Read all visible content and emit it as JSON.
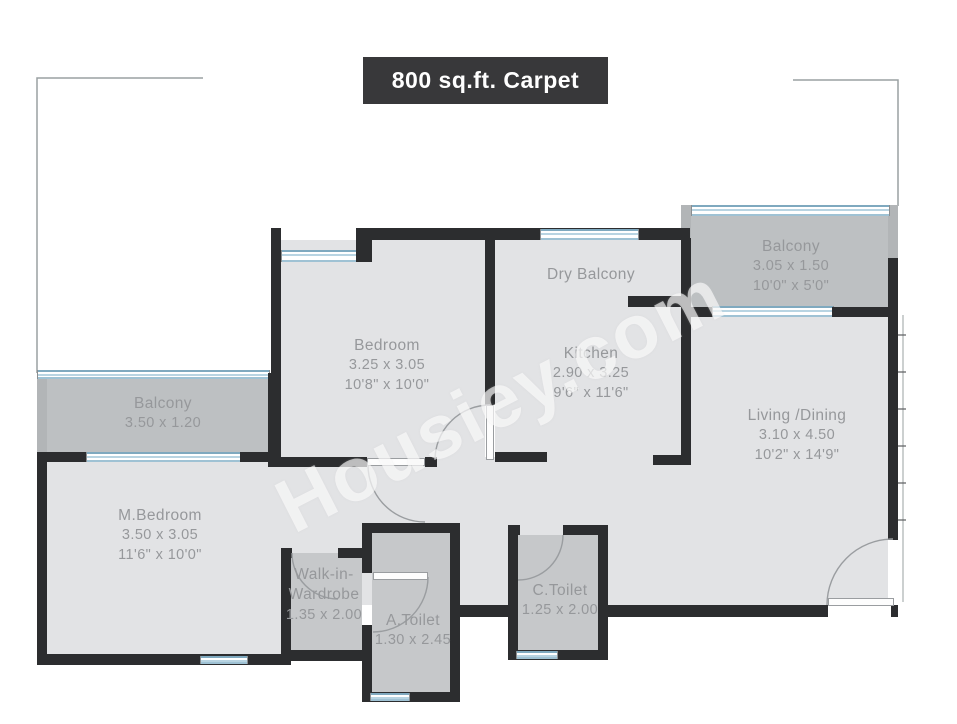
{
  "title": "800 sq.ft. Carpet",
  "watermark": "Housiey.com",
  "colors": {
    "wall": "#2c2d2f",
    "floor": "#e2e3e5",
    "balcony_floor": "#bdc0c2",
    "wet_area_floor": "#c6c8ca",
    "window_glass": "#b8d4e2",
    "title_background": "#38383a",
    "title_text": "#ffffff",
    "label_text": "#96989b",
    "watermark_text": "rgba(255,255,255,0.62)"
  },
  "rooms": [
    {
      "name": "Bedroom",
      "dim_m": "3.25 x 3.05",
      "dim_ft": "10'8\" x 10'0\""
    },
    {
      "name": "Dry Balcony",
      "dim_m": "",
      "dim_ft": ""
    },
    {
      "name": "Kitchen",
      "dim_m": "2.90 x 3.25",
      "dim_ft": "9'6\" x 11'6\""
    },
    {
      "name": "Balcony",
      "dim_m": "3.05 x 1.50",
      "dim_ft": "10'0\" x 5'0\""
    },
    {
      "name": "Living /Dining",
      "dim_m": "3.10 x 4.50",
      "dim_ft": "10'2\" x 14'9\""
    },
    {
      "name": "Balcony",
      "dim_m": "3.50 x 1.20",
      "dim_ft": ""
    },
    {
      "name": "M.Bedroom",
      "dim_m": "3.50 x 3.05",
      "dim_ft": "11'6\" x 10'0\""
    },
    {
      "name": "Walk-in-",
      "name2": "Wardrobe",
      "dim_m": "1.35 x 2.00",
      "dim_ft": ""
    },
    {
      "name": "A.Toilet",
      "dim_m": "1.30 x 2.45",
      "dim_ft": ""
    },
    {
      "name": "C.Toilet",
      "dim_m": "1.25 x 2.00",
      "dim_ft": ""
    }
  ]
}
